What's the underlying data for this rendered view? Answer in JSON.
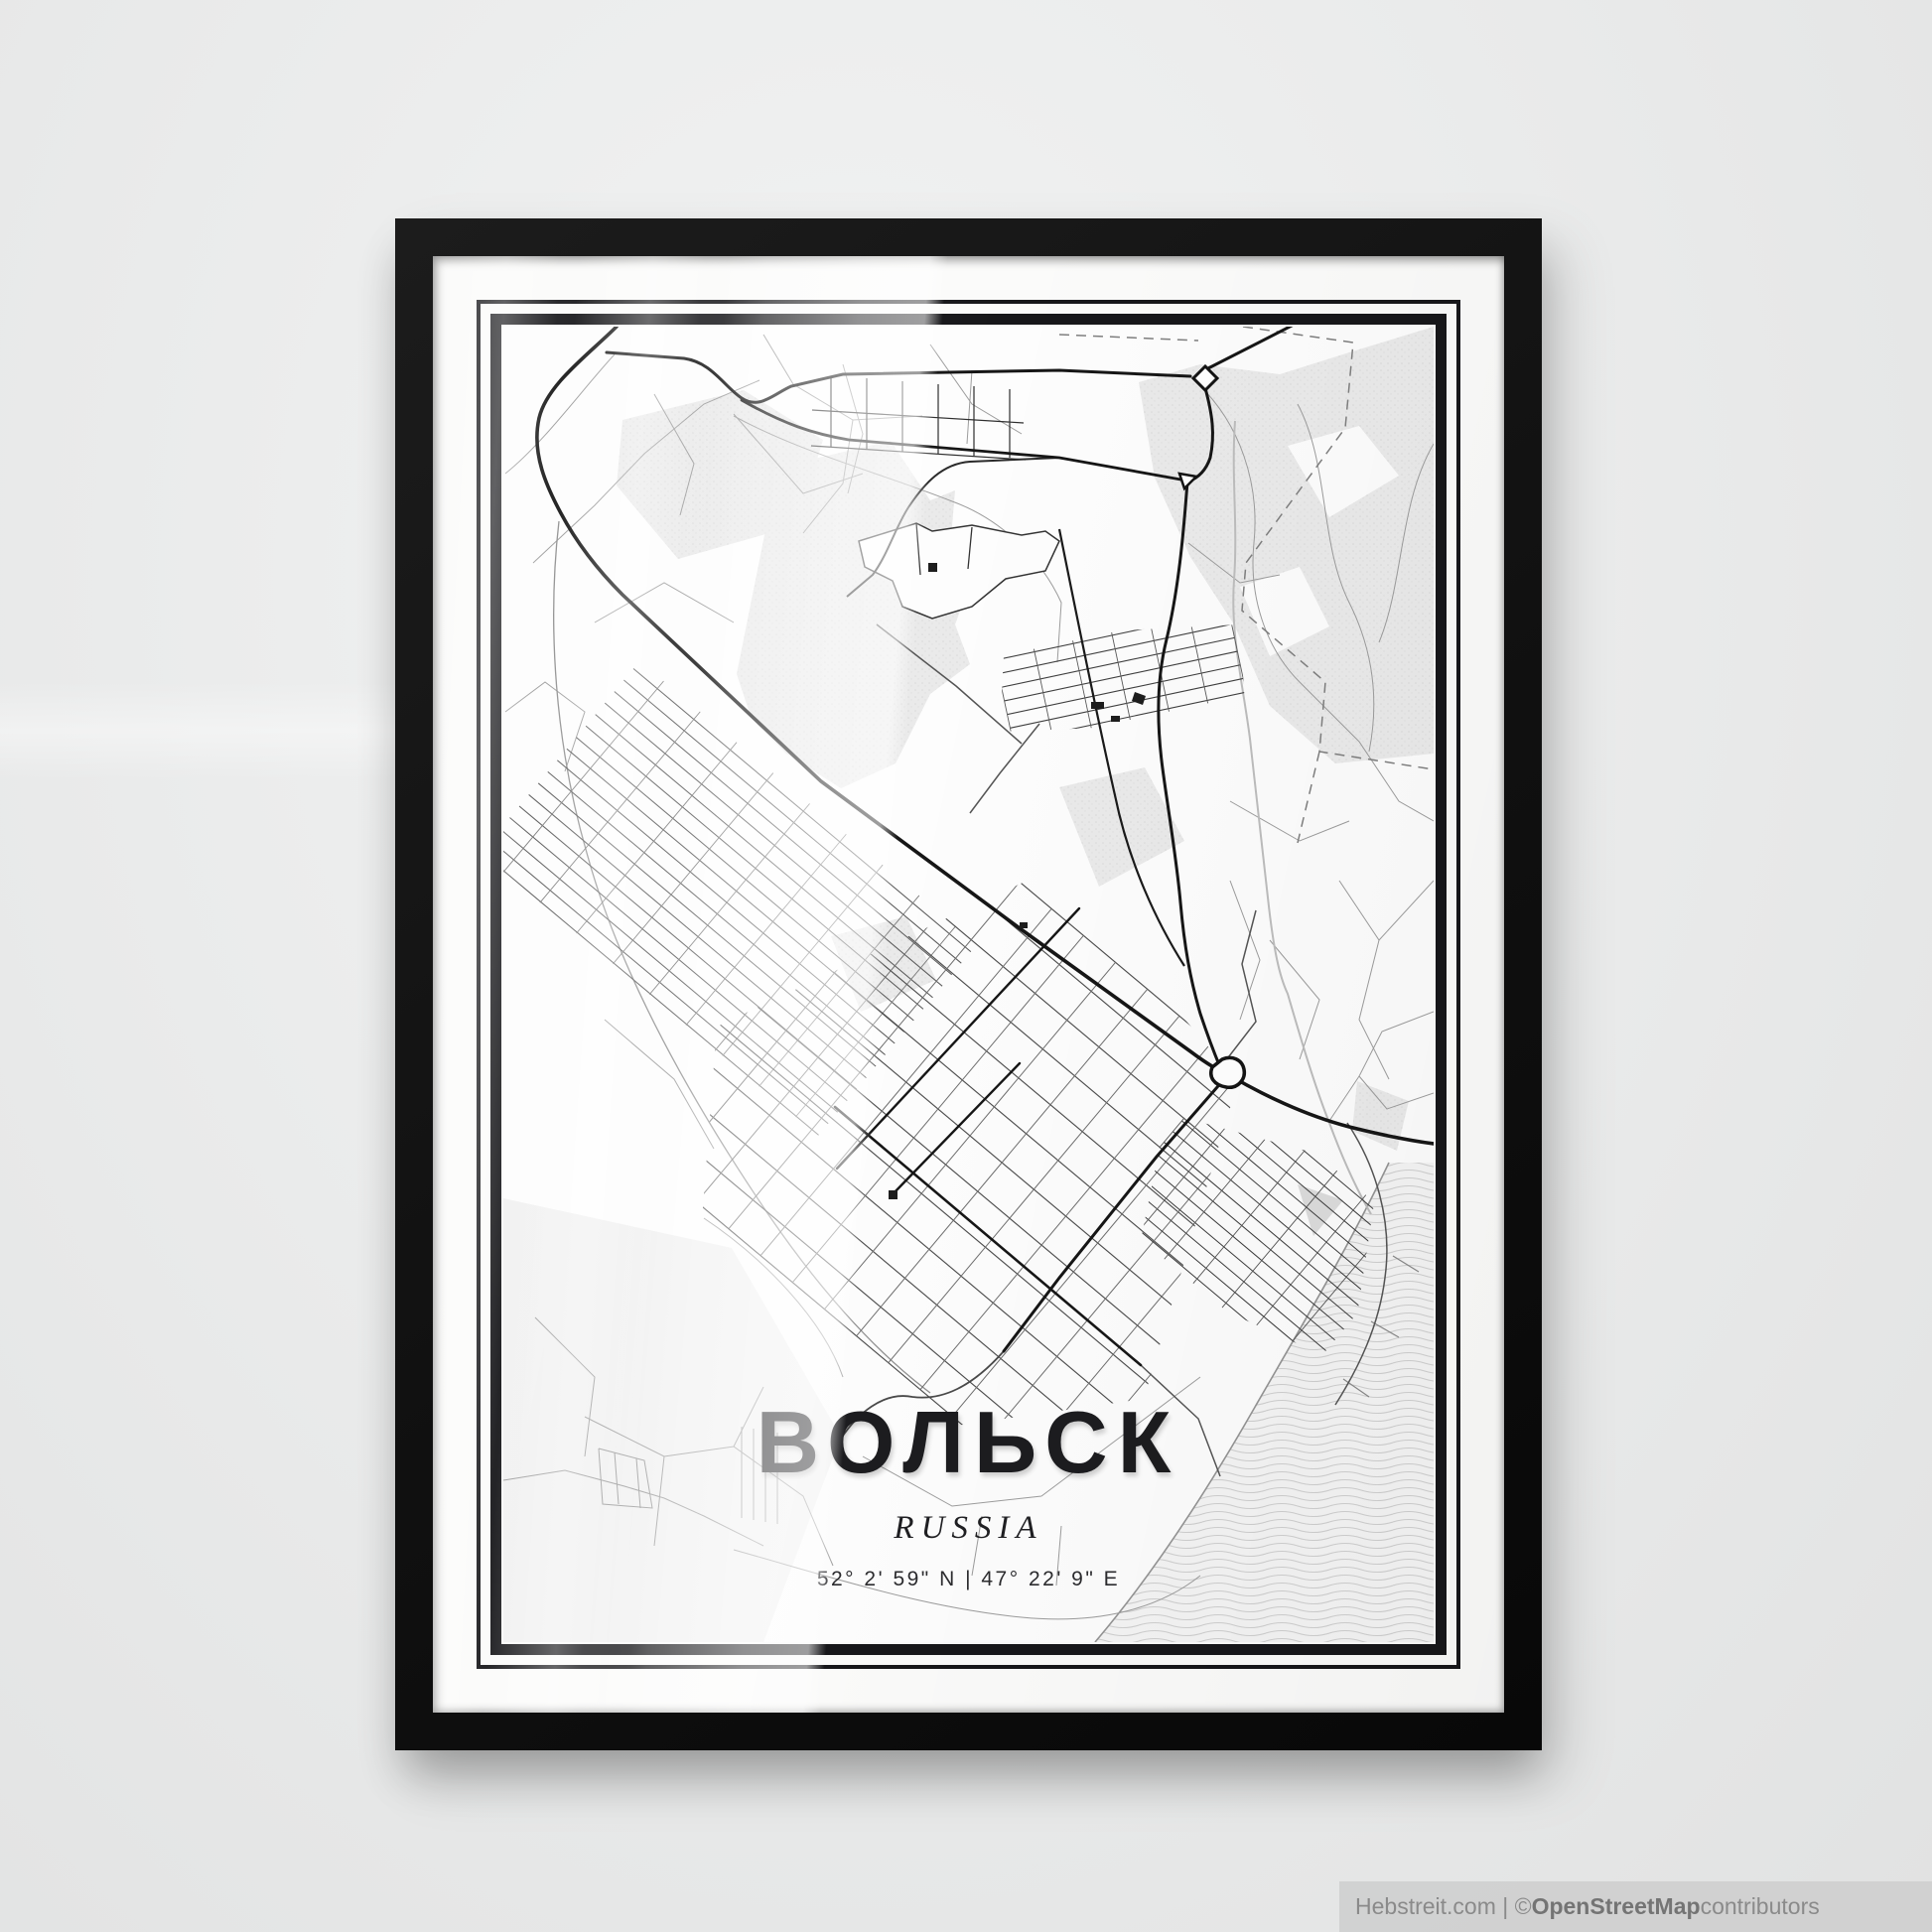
{
  "poster": {
    "city_title": "ВОЛЬСК",
    "country_subtitle": "RUSSIA",
    "coordinates": "52° 2' 59\" N | 47° 22' 9\" E"
  },
  "attribution": {
    "prefix": "Hebstreit.com | © ",
    "brand": "OpenStreetMap",
    "suffix": " contributors"
  },
  "colors": {
    "wall": "#eaebeb",
    "frame": "#141414",
    "mat": "#fbfbfa",
    "ink": "#1c1c1f",
    "road_main": "#161616",
    "road_minor": "#9c9c9c",
    "water_line": "#cfcfcf",
    "attribution_bg": "#d0d0d0",
    "attribution_text": "#8a8a8a"
  }
}
